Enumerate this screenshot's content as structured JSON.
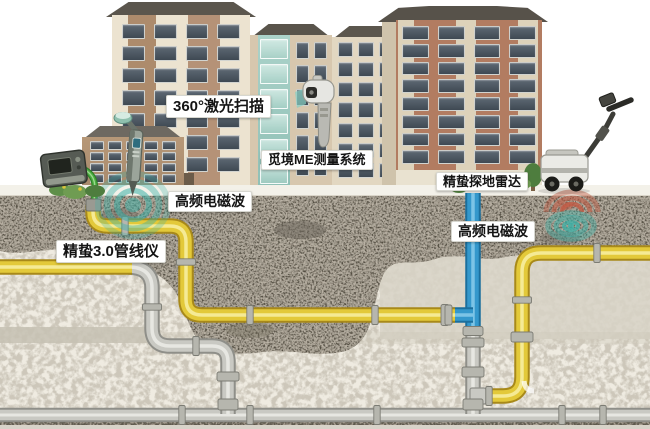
{
  "labels": {
    "laser_scan": "360°激光扫描",
    "me_system": "觅境ME测量系统",
    "gpr": "精蛰探地雷达",
    "em_right": "高频电磁波",
    "em_left": "高频电磁波",
    "locator": "精蛰3.0管线仪"
  },
  "colors": {
    "pipe_yellow": "#e3c93a",
    "pipe_yellow_dark": "#a8891a",
    "pipe_yellow_light": "#f6eda0",
    "pipe_gray": "#c9c9c3",
    "pipe_gray_dark": "#8f8f89",
    "pipe_gray_light": "#ecece8",
    "pipe_blue": "#3498cc",
    "pipe_blue_dark": "#1b6f9d",
    "pipe_blue_light": "#8fd0ec",
    "cable_green": "#4aae3e",
    "em_teal": "#3ab1a7",
    "em_red": "#c25a43",
    "soil_rock": "#8c8477",
    "soil_light": "#efebe1",
    "soil_band": "#c6c1b3"
  }
}
